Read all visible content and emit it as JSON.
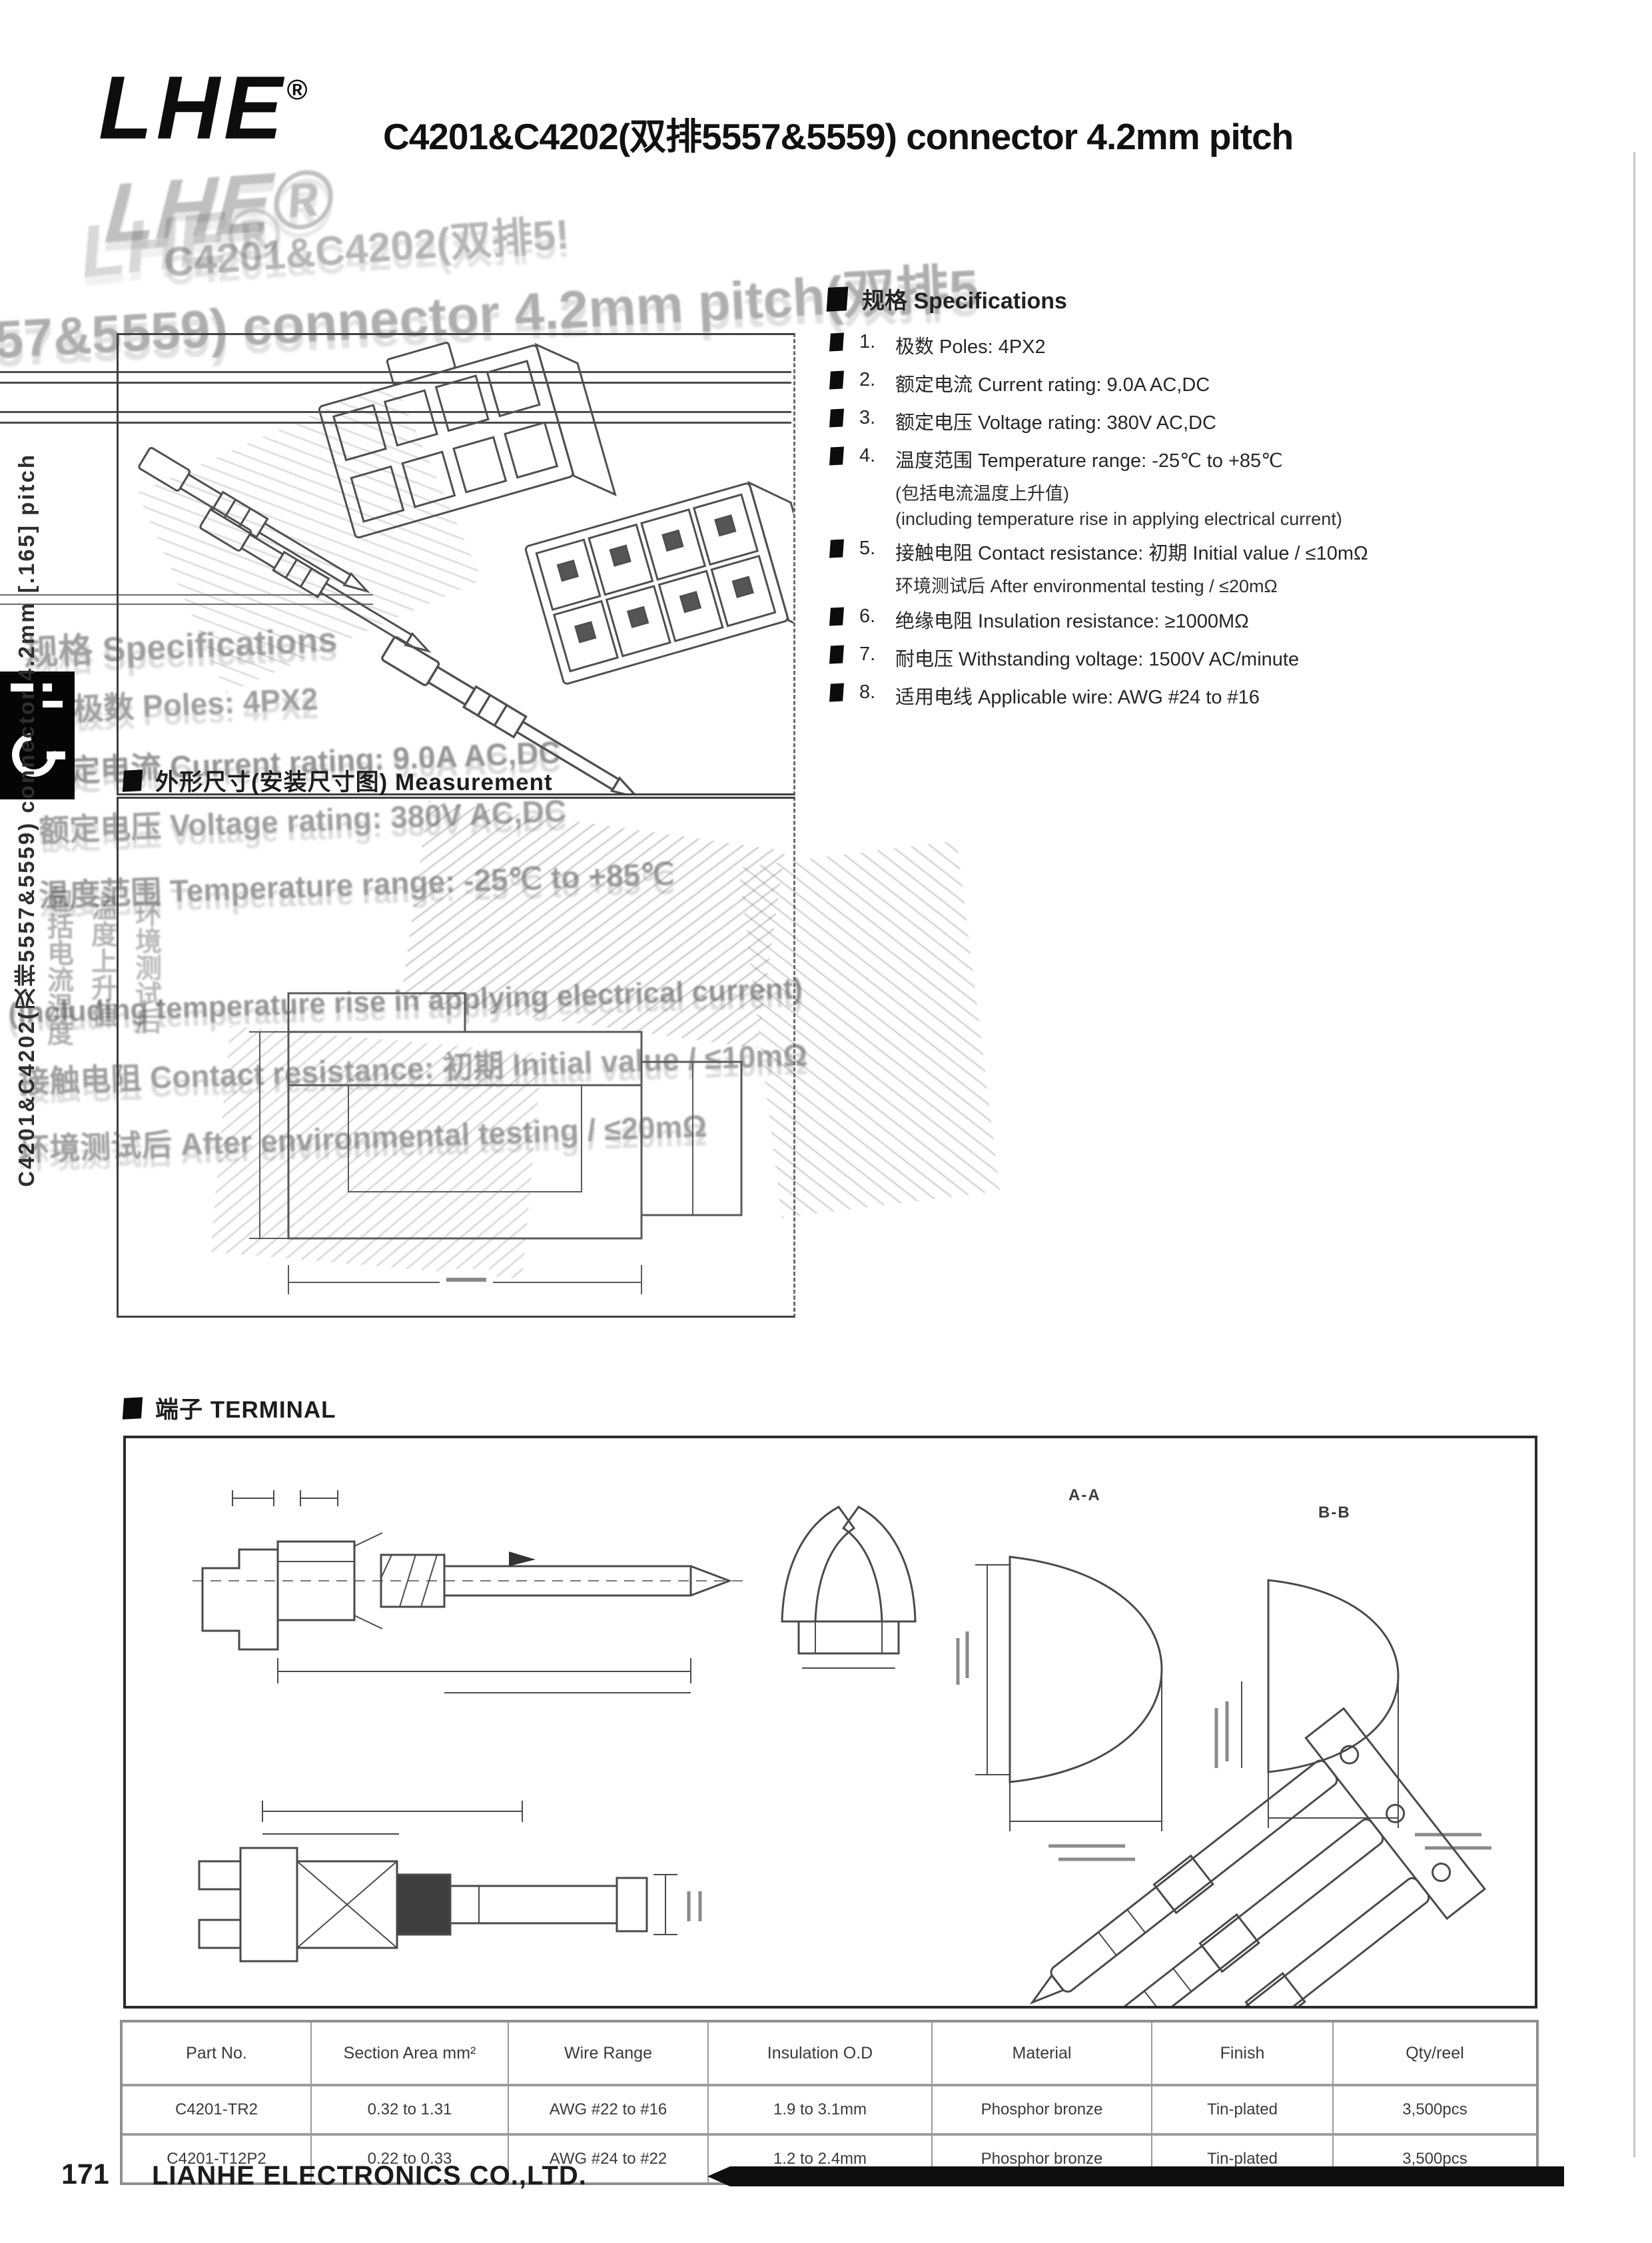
{
  "header": {
    "logo": "LHE",
    "reg": "®",
    "title": "C4201&C4202(双排5557&5559) connector 4.2mm pitch"
  },
  "sidebar": {
    "vertical_title": "C4201&C4202(双排5557&5559) connector 4.2mm [.165] pitch"
  },
  "specs": {
    "header": "规格 Specifications",
    "items": [
      {
        "num": "1.",
        "text": "极数 Poles: 4PX2"
      },
      {
        "num": "2.",
        "text": "额定电流 Current rating: 9.0A AC,DC"
      },
      {
        "num": "3.",
        "text": "额定电压 Voltage rating: 380V AC,DC"
      },
      {
        "num": "4.",
        "text": "温度范围 Temperature range: -25℃ to +85℃",
        "sub1": "(包括电流温度上升值)",
        "sub2": "(including temperature rise in applying electrical current)"
      },
      {
        "num": "5.",
        "text": "接触电阻 Contact resistance: 初期 Initial value / ≤10mΩ",
        "sub1": "环境测试后 After environmental testing / ≤20mΩ"
      },
      {
        "num": "6.",
        "text": "绝缘电阻 Insulation resistance: ≥1000MΩ"
      },
      {
        "num": "7.",
        "text": "耐电压 Withstanding voltage: 1500V AC/minute"
      },
      {
        "num": "8.",
        "text": "适用电线 Applicable wire: AWG #24 to #16"
      }
    ]
  },
  "measurement": {
    "header": "外形尺寸(安装尺寸图) Measurement"
  },
  "terminal": {
    "header": "端子 TERMINAL",
    "section_a": "A-A",
    "section_b": "B-B"
  },
  "table": {
    "headers": [
      "Part No.",
      "Section Area mm²",
      "Wire Range",
      "Insulation O.D",
      "Material",
      "Finish",
      "Qty/reel"
    ],
    "rows": [
      [
        "C4201-TR2",
        "0.32 to 1.31",
        "AWG #22 to #16",
        "1.9 to 3.1mm",
        "Phosphor bronze",
        "Tin-plated",
        "3,500pcs"
      ],
      [
        "C4201-T12P2",
        "0.22 to 0.33",
        "AWG #24 to #22",
        "1.2 to 2.4mm",
        "Phosphor bronze",
        "Tin-plated",
        "3,500pcs"
      ]
    ]
  },
  "footer": {
    "page_number": "171",
    "company": "LIANHE ELECTRONICS CO.,LTD."
  },
  "ghost": {
    "logo": "LHE®",
    "title_a": "C4201&C4202(双排5!",
    "title_b": "557&5559) connector 4.2mm pitch(双排5",
    "spec_header": "规格 Specifications",
    "item1": "1. 极数 Poles: 4PX2",
    "item2": "额定电流 Current rating: 9.0A AC,DC",
    "item3": "额定电压 Voltage rating: 380V AC,DC",
    "item4": "温度范围 Temperature range: -25℃ to +85℃",
    "including": "(including temperature rise in applying electrical current)",
    "contact": "接触电阻 Contact resistance: 初期 Initial value / ≤10mΩ",
    "after": "环境测试后 After environmental testing / ≤20mΩ",
    "col1": "包括电流温度",
    "col2": "温度上升值",
    "col3": "环境测试后"
  }
}
